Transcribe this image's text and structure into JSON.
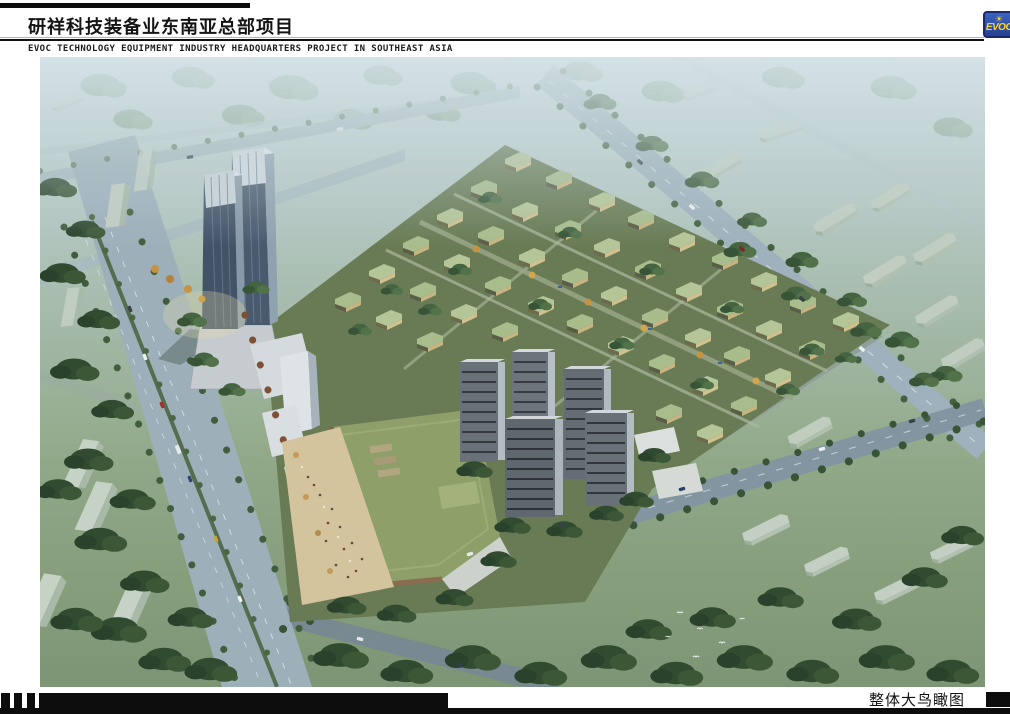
{
  "header": {
    "title_cn": "研祥科技装备业东南亚总部项目",
    "subtitle_en": "EVOC TECHNOLOGY EQUIPMENT INDUSTRY HEADQUARTERS PROJECT IN SOUTHEAST ASIA",
    "logo": {
      "text": "EVOC",
      "sun": "☀"
    }
  },
  "footer": {
    "caption": "整体大鸟瞰图"
  },
  "colors": {
    "bar_black": "#0d0d0d",
    "logo_blue": "#2b4da8",
    "logo_border": "#1b2a6b",
    "logo_yellow": "#ffd81e",
    "haze_sky": "#c9d8dc",
    "foliage_dark": "#32502f",
    "foliage_hazy": "#84a083",
    "road_gray": "#a3b5bf",
    "villa_roof_green": "#b6c795",
    "villa_wall_tan": "#d2c28e",
    "office_tower_facade": "#46566a",
    "residential_tower_facade": "#6a7278",
    "commercial_green_roof": "#8e9f66",
    "plaza_sand": "#d6c69c",
    "autumn_tree_brown": "#7c4a2c",
    "accent_orange_tree": "#c8923c"
  }
}
